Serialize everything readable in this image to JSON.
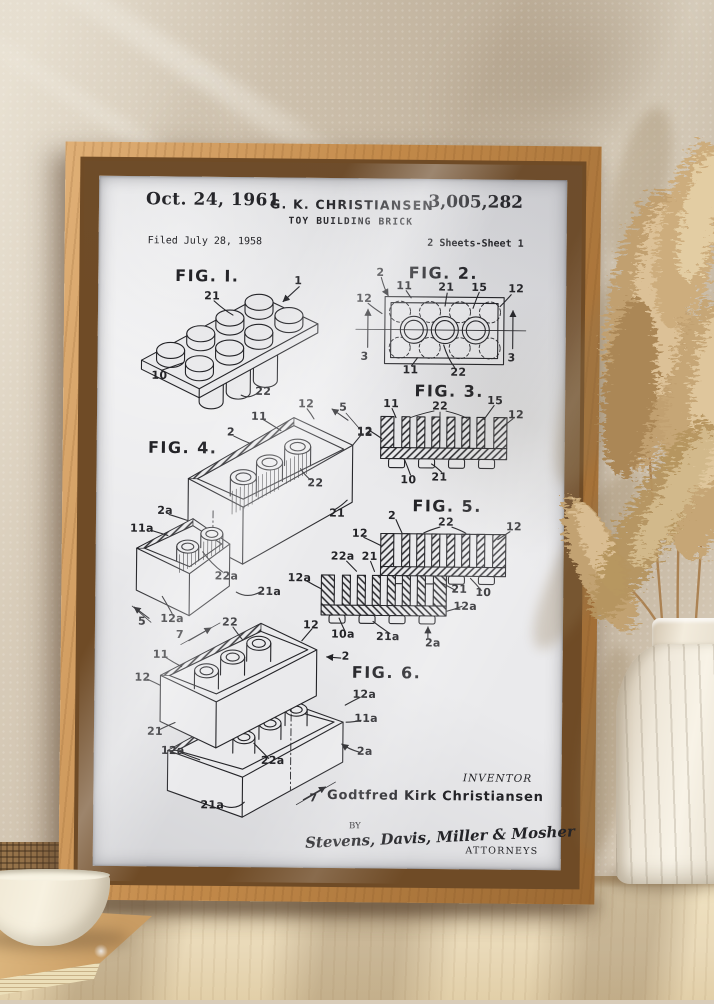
{
  "theme": {
    "wall": "#d8ccb9",
    "wood": "#c28949",
    "paper": "#eaeaec",
    "ink": "#232327",
    "table": "#e9d9b8",
    "vase": "#f2ecdf",
    "pampas": "#c6a676"
  },
  "patent": {
    "header": {
      "date": "Oct. 24, 1961",
      "inventor_code": "G. K. CHRISTIANSEN",
      "title": "TOY BUILDING BRICK",
      "number": "3,005,282",
      "filed": "Filed July 28, 1958",
      "sheet": "2 Sheets-Sheet 1"
    },
    "figures": [
      {
        "title": "FIG. I.",
        "title_pos": {
          "x": 205,
          "y": 277
        },
        "labels": [
          {
            "t": "1",
            "x": 296,
            "y": 281
          },
          {
            "t": "21",
            "x": 210,
            "y": 297
          },
          {
            "t": "10",
            "x": 158,
            "y": 377
          },
          {
            "t": "22",
            "x": 262,
            "y": 392
          }
        ]
      },
      {
        "title": "FIG. 2.",
        "title_pos": {
          "x": 441,
          "y": 272
        },
        "labels": [
          {
            "t": "2",
            "x": 378,
            "y": 272
          },
          {
            "t": "11",
            "x": 402,
            "y": 285
          },
          {
            "t": "21",
            "x": 444,
            "y": 286
          },
          {
            "t": "15",
            "x": 477,
            "y": 286
          },
          {
            "t": "12",
            "x": 514,
            "y": 287
          },
          {
            "t": "12",
            "x": 362,
            "y": 298
          },
          {
            "t": "3",
            "x": 363,
            "y": 356
          },
          {
            "t": "3",
            "x": 510,
            "y": 356
          },
          {
            "t": "11",
            "x": 409,
            "y": 369
          },
          {
            "t": "22",
            "x": 457,
            "y": 371
          }
        ]
      },
      {
        "title": "FIG. 3.",
        "title_pos": {
          "x": 448,
          "y": 390
        },
        "labels": [
          {
            "t": "11",
            "x": 390,
            "y": 403
          },
          {
            "t": "22",
            "x": 439,
            "y": 405
          },
          {
            "t": "15",
            "x": 494,
            "y": 399
          },
          {
            "t": "12",
            "x": 515,
            "y": 413
          },
          {
            "t": "12",
            "x": 364,
            "y": 431
          },
          {
            "t": "10",
            "x": 408,
            "y": 479
          },
          {
            "t": "21",
            "x": 439,
            "y": 476
          }
        ]
      },
      {
        "title": "FIG. 4.",
        "title_pos": {
          "x": 182,
          "y": 449
        },
        "labels": [
          {
            "t": "11",
            "x": 258,
            "y": 417
          },
          {
            "t": "2",
            "x": 230,
            "y": 433
          },
          {
            "t": "12",
            "x": 305,
            "y": 404
          },
          {
            "t": "5",
            "x": 342,
            "y": 407
          },
          {
            "t": "12",
            "x": 364,
            "y": 432
          },
          {
            "t": "22",
            "x": 315,
            "y": 483
          },
          {
            "t": "21",
            "x": 337,
            "y": 513
          },
          {
            "t": "2a",
            "x": 165,
            "y": 512
          },
          {
            "t": "11a",
            "x": 142,
            "y": 530
          },
          {
            "t": "22a",
            "x": 227,
            "y": 577
          },
          {
            "t": "21a",
            "x": 270,
            "y": 592
          },
          {
            "t": "12a",
            "x": 173,
            "y": 620
          },
          {
            "t": "5",
            "x": 143,
            "y": 623
          }
        ]
      },
      {
        "title": "FIG. 5.",
        "title_pos": {
          "x": 447,
          "y": 505
        },
        "labels": [
          {
            "t": "2",
            "x": 392,
            "y": 515
          },
          {
            "t": "22",
            "x": 446,
            "y": 521
          },
          {
            "t": "12",
            "x": 514,
            "y": 525
          },
          {
            "t": "12",
            "x": 360,
            "y": 533
          },
          {
            "t": "22a",
            "x": 343,
            "y": 556
          },
          {
            "t": "21",
            "x": 370,
            "y": 556
          },
          {
            "t": "12a",
            "x": 300,
            "y": 578
          },
          {
            "t": "21",
            "x": 460,
            "y": 588
          },
          {
            "t": "10",
            "x": 484,
            "y": 591
          },
          {
            "t": "12a",
            "x": 466,
            "y": 605
          },
          {
            "t": "10a",
            "x": 344,
            "y": 634
          },
          {
            "t": "21a",
            "x": 389,
            "y": 636
          },
          {
            "t": "2a",
            "x": 434,
            "y": 642
          }
        ]
      },
      {
        "title": "FIG. 6.",
        "title_pos": {
          "x": 388,
          "y": 672
        },
        "labels": [
          {
            "t": "7",
            "x": 181,
            "y": 636
          },
          {
            "t": "22",
            "x": 231,
            "y": 623
          },
          {
            "t": "12",
            "x": 312,
            "y": 625
          },
          {
            "t": "11",
            "x": 162,
            "y": 656
          },
          {
            "t": "2",
            "x": 347,
            "y": 656
          },
          {
            "t": "12",
            "x": 144,
            "y": 679
          },
          {
            "t": "21",
            "x": 157,
            "y": 733
          },
          {
            "t": "12a",
            "x": 175,
            "y": 752
          },
          {
            "t": "22a",
            "x": 275,
            "y": 761
          },
          {
            "t": "21a",
            "x": 215,
            "y": 806
          },
          {
            "t": "12a",
            "x": 366,
            "y": 694
          },
          {
            "t": "11a",
            "x": 368,
            "y": 718
          },
          {
            "t": "2a",
            "x": 367,
            "y": 751
          },
          {
            "t": "7",
            "x": 316,
            "y": 798
          }
        ]
      }
    ],
    "footer": {
      "inventor_caption": "INVENTOR",
      "inventor_name": "Godtfred Kirk Christiansen",
      "by": "BY",
      "signature": "Stevens, Davis, Miller & Mosher",
      "attorneys": "ATTORNEYS"
    }
  }
}
